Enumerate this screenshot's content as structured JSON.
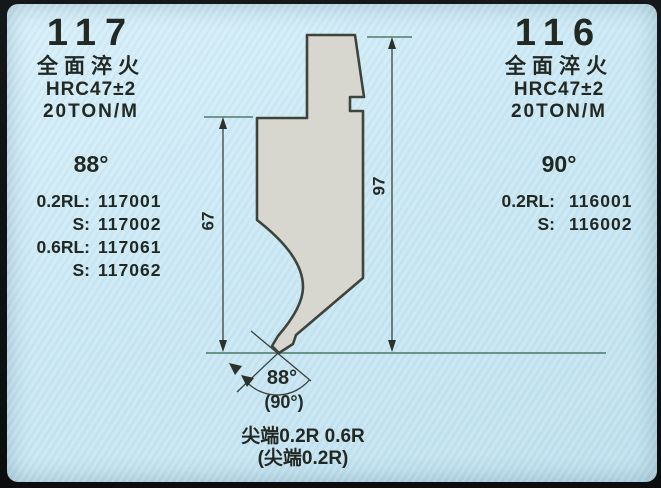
{
  "colors": {
    "page_background": "#cbe8f4",
    "photo_frame": "#101315",
    "punch_fill": "#d7d7d0",
    "punch_outline": "#3f443b",
    "dimension_line": "#39433d",
    "baseline": "#4f7d6d",
    "text": "#222923"
  },
  "left_product": {
    "model": "117",
    "treatment": "全面淬火",
    "hardness": "HRC47±2",
    "tonnage": "20TON/M",
    "angle": "88°",
    "parts": [
      {
        "label": "0.2RL:",
        "value": "117001"
      },
      {
        "label": "S:",
        "value": "117002"
      },
      {
        "label": "0.6RL:",
        "value": "117061"
      },
      {
        "label": "S:",
        "value": "117062"
      }
    ]
  },
  "right_product": {
    "model": "116",
    "treatment": "全面淬火",
    "hardness": "HRC47±2",
    "tonnage": "20TON/M",
    "angle": "90°",
    "parts": [
      {
        "label": "0.2RL:",
        "value": "116001"
      },
      {
        "label": "S:",
        "value": "116002"
      }
    ]
  },
  "diagram": {
    "dim_height_body": "67",
    "dim_height_total": "97",
    "tip_angle": "88°",
    "tip_angle_alt": "(90°)",
    "note_line1": "尖端0.2R 0.6R",
    "note_line2": "(尖端0.2R)"
  }
}
